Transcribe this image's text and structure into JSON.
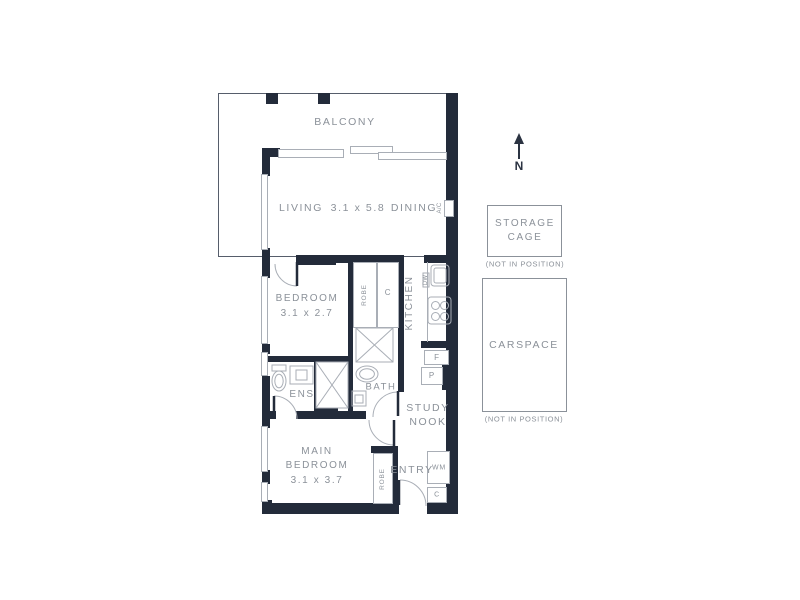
{
  "rooms": {
    "balcony": {
      "label": "BALCONY"
    },
    "living": {
      "label": "LIVING",
      "dims": "3.1 x 5.8"
    },
    "dining": {
      "label": "DINING"
    },
    "bedroom": {
      "label": "BEDROOM",
      "dims": "3.1 x 2.7"
    },
    "kitchen": {
      "label": "KITCHEN"
    },
    "ens": {
      "label": "ENS"
    },
    "bath": {
      "label": "BATH"
    },
    "study": {
      "line1": "STUDY",
      "line2": "NOOK"
    },
    "main_bedroom": {
      "line1": "MAIN",
      "line2": "BEDROOM",
      "dims": "3.1 x 3.7"
    },
    "entry": {
      "label": "ENTRY"
    }
  },
  "joinery": {
    "robe_bedroom": "ROBE",
    "cupboard_hall": "C",
    "dishwasher": "DW",
    "fridge": "F",
    "pantry": "P",
    "ac_unit": "A/C",
    "robe_main": "ROBE",
    "washing_machine": "WM",
    "cupboard_entry": "C"
  },
  "annex": {
    "north": "N",
    "storage_cage": {
      "line1": "STORAGE",
      "line2": "CAGE",
      "note": "(NOT IN POSITION)"
    },
    "carspace": {
      "label": "CARSPACE",
      "note": "(NOT IN POSITION)"
    }
  },
  "colors": {
    "wall": "#232b3a",
    "thin_line": "#a9aeb6",
    "text": "#8b9199"
  }
}
